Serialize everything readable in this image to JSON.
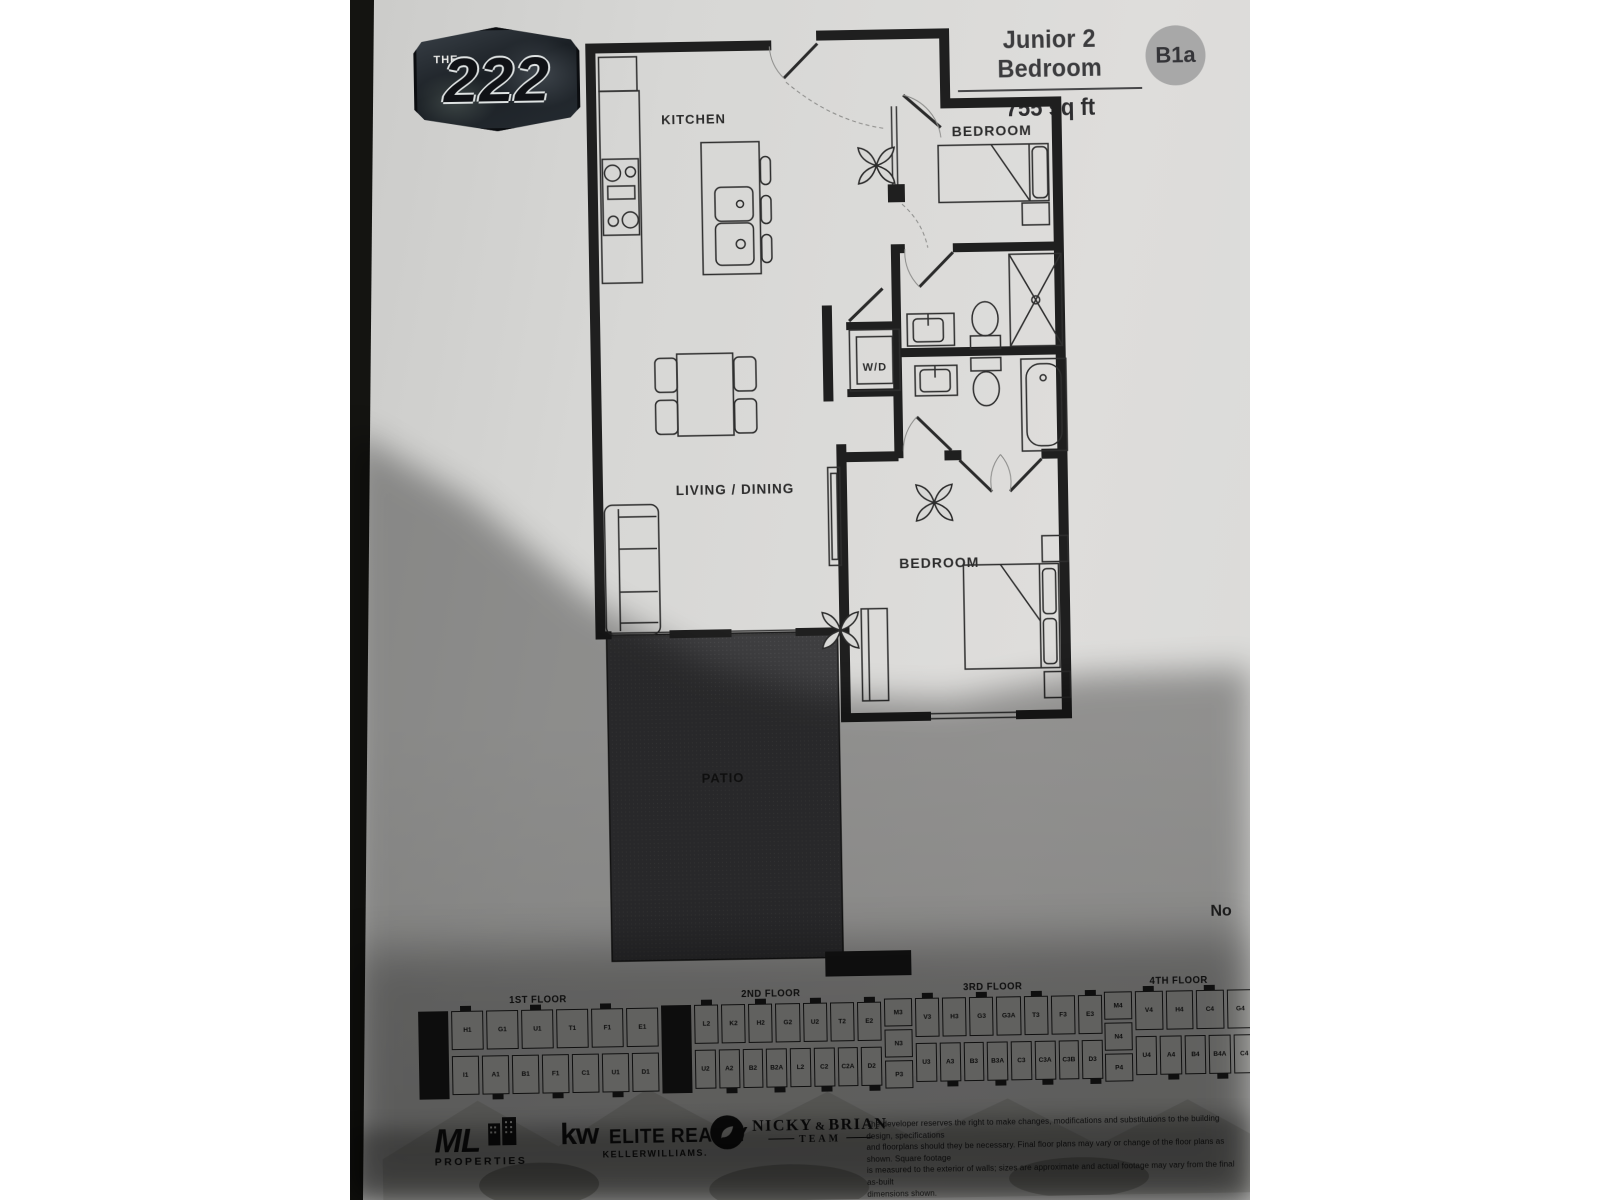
{
  "header": {
    "logo_the": "THE",
    "logo_number": "222",
    "plan_name": "Junior 2 Bedroom",
    "area": "755 sq ft",
    "unit_badge": "B1a",
    "badge_bg": "#a8a8a8"
  },
  "floorplan": {
    "labels": {
      "kitchen": "KITCHEN",
      "bedroom_top": "BEDROOM",
      "wd": "W/D",
      "living_dining": "LIVING / DINING",
      "bedroom_bottom": "BEDROOM",
      "patio": "PATIO"
    },
    "wall_color": "#1f1f1f",
    "patio_color": "#3e3e40"
  },
  "note_cut": "No",
  "floor_plates": [
    {
      "label": "1ST FLOOR",
      "left_units": [],
      "top_units": [
        "H1",
        "G1",
        "U1",
        "T1",
        "F1",
        "E1"
      ],
      "bottom_units": [
        "I1",
        "A1",
        "B1",
        "F1",
        "C1",
        "U1",
        "D1"
      ]
    },
    {
      "label": "2ND FLOOR",
      "left_units": [],
      "top_units": [
        "L2",
        "K2",
        "H2",
        "G2",
        "U2",
        "T2",
        "E2"
      ],
      "bottom_units": [
        "U2",
        "A2",
        "B2",
        "B2A",
        "L2",
        "C2",
        "C2A",
        "D2"
      ]
    },
    {
      "label": "3RD FLOOR",
      "left_units": [
        "M3",
        "N3",
        "P3"
      ],
      "top_units": [
        "V3",
        "H3",
        "G3",
        "G3A",
        "T3",
        "F3",
        "E3"
      ],
      "bottom_units": [
        "U3",
        "A3",
        "B3",
        "B3A",
        "C3",
        "C3A",
        "C3B",
        "D3"
      ]
    },
    {
      "label": "4TH FLOOR",
      "left_units": [
        "M4",
        "N4",
        "P4"
      ],
      "top_units": [
        "V4",
        "H4",
        "C4",
        "G4"
      ],
      "bottom_units": [
        "U4",
        "A4",
        "B4",
        "B4A",
        "C4"
      ]
    }
  ],
  "footer": {
    "logos": {
      "ml_big": "ML",
      "ml_sub": "PROPERTIES",
      "kw_big": "kw",
      "kw_main": "ELITE REALTY",
      "kw_sub": "KELLERWILLIAMS.",
      "nb_first": "NICKY",
      "nb_amp": "&",
      "nb_second": "BRIAN",
      "nb_team": "TEAM"
    },
    "disclaimer_lines": [
      "The developer reserves the right to make changes, modifications and substitutions to the building design, specifications",
      "and floorplans should they be necessary. Final floor plans may vary or change of the floor plans as shown. Square footage",
      "is measured to the exterior of walls; sizes are approximate and actual footage may vary from the final as-built",
      "dimensions shown."
    ]
  }
}
